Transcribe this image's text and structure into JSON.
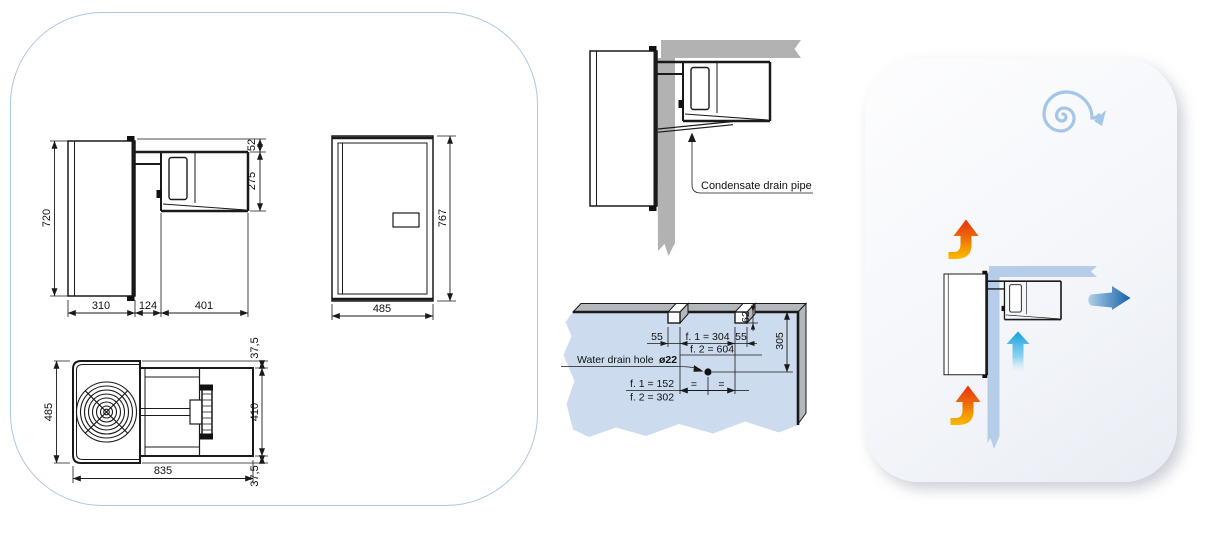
{
  "dimensions": {
    "side_view": {
      "height": "720",
      "depth": "310",
      "gap": "124",
      "condensing_depth": "401",
      "top_offset": "52",
      "condensing_height": "275"
    },
    "front_view": {
      "width": "485",
      "height": "767"
    },
    "top_view": {
      "width": "485",
      "length": "835",
      "margin_top": "37,5",
      "body": "410",
      "margin_bottom": "37,5"
    }
  },
  "installation": {
    "condensate_label": "Condensate drain pipe",
    "wall_cutout": {
      "drain_label": "Water drain hole",
      "drain_diameter": "ø22",
      "notch_left": "55",
      "f1_width": "f. 1 = 304",
      "f2_width": "f. 2 = 604",
      "notch_right": "55",
      "notch_depth": "62",
      "hole_depth": "305",
      "f1_center": "f. 1 = 152",
      "f2_center": "f. 2 = 302",
      "equal_left": "=",
      "equal_right": "="
    }
  },
  "air_flow": {
    "title_line_1": "AIR",
    "title_line_2": "FLOW"
  },
  "colors": {
    "panel_border": "#abc7e3",
    "drawing_ink": "#1a1a1a",
    "wall_gray": "#b2b2b2",
    "wall_blue": "#b5cde9",
    "cutout_blue": "#ccdbee",
    "face_gray": "#b4b8bd",
    "hot_arrow_top": "#e63312",
    "hot_arrow_bottom": "#fbba00",
    "cold_arrow": "#1aa3df",
    "outflow_arrow": "#1061a9",
    "spiral_blue": "#a5c6e8",
    "title_gray": "#8e9094"
  }
}
